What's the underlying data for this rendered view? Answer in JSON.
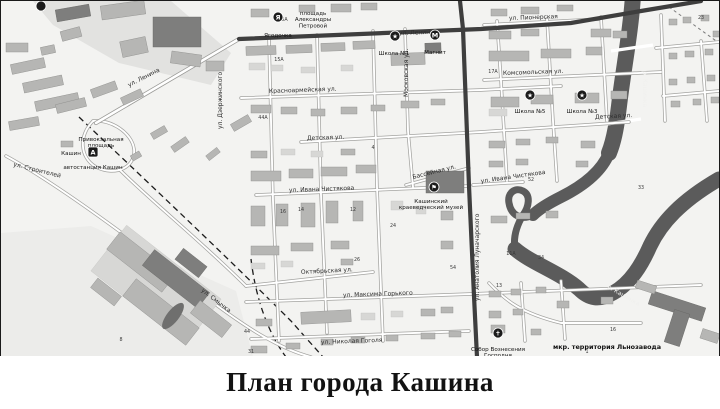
{
  "title": "План города Кашина",
  "map": {
    "colors": {
      "background": "#f3f3f1",
      "river": "#5b5b5b",
      "major_road": "#3e3e3e",
      "building": "#b6b6b4",
      "building_dark": "#7e7e7d",
      "industrial_zone": "#e2e2e0"
    },
    "river_name": "р. Кашинка",
    "street_labels": [
      {
        "t": "ул. Ленина",
        "x": 128,
        "y": 86,
        "r": -27
      },
      {
        "t": "ул. Ленина",
        "x": 398,
        "y": 34,
        "r": -2
      },
      {
        "t": "ул. Пионерская",
        "x": 508,
        "y": 19,
        "r": -2
      },
      {
        "t": "Красноармейская ул.",
        "x": 268,
        "y": 92,
        "r": -2
      },
      {
        "t": "Комсомольская ул.",
        "x": 502,
        "y": 74,
        "r": -2
      },
      {
        "t": "Детская ул.",
        "x": 594,
        "y": 118,
        "r": -3
      },
      {
        "t": "Детская ул.",
        "x": 306,
        "y": 139,
        "r": -2
      },
      {
        "t": "ул. Ивана Чистякова",
        "x": 288,
        "y": 191,
        "r": -2
      },
      {
        "t": "ул. Ивана Чистякова",
        "x": 480,
        "y": 182,
        "r": -8
      },
      {
        "t": "Бассейная ул.",
        "x": 412,
        "y": 178,
        "r": -14
      },
      {
        "t": "Московская ул.",
        "x": 407,
        "y": 96,
        "r": -90
      },
      {
        "t": "ул. Дзержинского",
        "x": 221,
        "y": 128,
        "r": -90
      },
      {
        "t": "ул. Анатолия Луначарского",
        "x": 478,
        "y": 300,
        "r": -90
      },
      {
        "t": "Октябрьская ул.",
        "x": 300,
        "y": 273,
        "r": -3
      },
      {
        "t": "ул. Максима Горького",
        "x": 342,
        "y": 296,
        "r": -2
      },
      {
        "t": "ул. Смычка",
        "x": 200,
        "y": 290,
        "r": 38
      },
      {
        "t": "ул. Строителей",
        "x": 12,
        "y": 165,
        "r": 14
      },
      {
        "t": "ул. Николая Гоголя",
        "x": 320,
        "y": 343,
        "r": -2
      }
    ],
    "river_labels": [
      {
        "t": "р. Кашинка",
        "x": 642,
        "y": 70,
        "r": 90
      },
      {
        "t": "р. Кашинка",
        "x": 606,
        "y": 287,
        "r": 30
      }
    ],
    "place_labels": [
      {
        "lines": [
          "площадь",
          "Александры",
          "Петровой"
        ],
        "x": 312,
        "y": 8,
        "b": 0
      },
      {
        "lines": [
          "Привокзальная",
          "площадь"
        ],
        "x": 100,
        "y": 134,
        "b": 0
      },
      {
        "lines": [
          "Кашин"
        ],
        "x": 70,
        "y": 148,
        "b": 1
      },
      {
        "lines": [
          "автостанция Кашин"
        ],
        "x": 92,
        "y": 162,
        "b": 1
      },
      {
        "lines": [
          "Ягодочка"
        ],
        "x": 277,
        "y": 30,
        "b": 1
      },
      {
        "lines": [
          "Школа №1"
        ],
        "x": 393,
        "y": 48,
        "b": 1
      },
      {
        "lines": [
          "Магнит"
        ],
        "x": 434,
        "y": 47,
        "b": 1
      },
      {
        "lines": [
          "Школа №5"
        ],
        "x": 529,
        "y": 106,
        "b": 1
      },
      {
        "lines": [
          "Школа №3"
        ],
        "x": 581,
        "y": 106,
        "b": 1
      },
      {
        "lines": [
          "Кашинский",
          "краеведческий музей"
        ],
        "x": 430,
        "y": 196,
        "b": 1
      },
      {
        "lines": [
          "Собор Вознесения",
          "Господня"
        ],
        "x": 497,
        "y": 344,
        "b": 1
      },
      {
        "lines": [
          "мкр. территория Льнозавода"
        ],
        "x": 606,
        "y": 342,
        "b": 2
      }
    ],
    "house_numbers": [
      {
        "t": "15А",
        "x": 278,
        "y": 60
      },
      {
        "t": "44А",
        "x": 262,
        "y": 118
      },
      {
        "t": "4",
        "x": 372,
        "y": 148
      },
      {
        "t": "12",
        "x": 352,
        "y": 210
      },
      {
        "t": "14",
        "x": 300,
        "y": 210
      },
      {
        "t": "16",
        "x": 282,
        "y": 212
      },
      {
        "t": "26",
        "x": 356,
        "y": 260
      },
      {
        "t": "24",
        "x": 392,
        "y": 226
      },
      {
        "t": "11А",
        "x": 510,
        "y": 254
      },
      {
        "t": "13",
        "x": 498,
        "y": 286
      },
      {
        "t": "34",
        "x": 540,
        "y": 258
      },
      {
        "t": "54",
        "x": 452,
        "y": 268
      },
      {
        "t": "16",
        "x": 612,
        "y": 330
      },
      {
        "t": "23",
        "x": 700,
        "y": 18
      },
      {
        "t": "33",
        "x": 640,
        "y": 188
      },
      {
        "t": "31",
        "x": 250,
        "y": 352
      },
      {
        "t": "44",
        "x": 246,
        "y": 332
      },
      {
        "t": "52",
        "x": 530,
        "y": 180
      },
      {
        "t": "25А",
        "x": 282,
        "y": 20
      },
      {
        "t": "17А",
        "x": 492,
        "y": 72
      },
      {
        "t": "8",
        "x": 120,
        "y": 340
      },
      {
        "t": "1",
        "x": 586,
        "y": 352
      }
    ],
    "pois": [
      {
        "id": "bus-station",
        "glyph": "А",
        "shape": "square",
        "x": 92,
        "y": 151
      },
      {
        "id": "shop-yagodochka",
        "glyph": "Я",
        "shape": "circle",
        "x": 277,
        "y": 16
      },
      {
        "id": "school-1",
        "glyph": "★",
        "shape": "circle",
        "x": 394,
        "y": 35
      },
      {
        "id": "shop-magnit",
        "glyph": "М",
        "shape": "circle",
        "x": 434,
        "y": 34
      },
      {
        "id": "school-5",
        "glyph": "★",
        "shape": "circle",
        "x": 529,
        "y": 94
      },
      {
        "id": "school-3",
        "glyph": "★",
        "shape": "circle",
        "x": 581,
        "y": 94
      },
      {
        "id": "museum",
        "glyph": "⚑",
        "shape": "circle",
        "x": 433,
        "y": 186
      },
      {
        "id": "church",
        "glyph": "✝",
        "shape": "circle",
        "x": 497,
        "y": 332
      },
      {
        "id": "transit-stop",
        "glyph": "",
        "shape": "circle",
        "x": 40,
        "y": 5
      }
    ],
    "buildings": [
      [
        55,
        6,
        34,
        12,
        -10,
        2
      ],
      [
        100,
        2,
        44,
        14,
        -8,
        1
      ],
      [
        152,
        16,
        48,
        30,
        0,
        2
      ],
      [
        120,
        38,
        26,
        16,
        -12,
        1
      ],
      [
        60,
        28,
        20,
        10,
        -15,
        1
      ],
      [
        170,
        52,
        30,
        12,
        8,
        1
      ],
      [
        205,
        60,
        18,
        10,
        0,
        1
      ],
      [
        10,
        60,
        34,
        10,
        -12,
        1
      ],
      [
        22,
        78,
        40,
        10,
        -12,
        1
      ],
      [
        34,
        96,
        44,
        10,
        -12,
        1
      ],
      [
        8,
        118,
        30,
        9,
        -10,
        1
      ],
      [
        55,
        100,
        30,
        9,
        -14,
        1
      ],
      [
        90,
        84,
        26,
        9,
        -20,
        1
      ],
      [
        120,
        92,
        22,
        8,
        -25,
        1
      ],
      [
        5,
        42,
        22,
        9,
        0,
        1
      ],
      [
        40,
        45,
        14,
        8,
        -12,
        1
      ],
      [
        150,
        128,
        16,
        7,
        -30,
        1
      ],
      [
        170,
        140,
        18,
        7,
        -35,
        1
      ],
      [
        205,
        150,
        14,
        6,
        -38,
        1
      ],
      [
        230,
        118,
        20,
        8,
        -30,
        1
      ],
      [
        60,
        140,
        12,
        6,
        0,
        1
      ],
      [
        130,
        152,
        10,
        6,
        -30,
        1
      ],
      [
        250,
        8,
        18,
        8,
        0,
        1
      ],
      [
        298,
        4,
        16,
        7,
        0,
        1
      ],
      [
        330,
        3,
        20,
        8,
        0,
        1
      ],
      [
        360,
        2,
        16,
        7,
        0,
        1
      ],
      [
        245,
        45,
        30,
        9,
        -2,
        1
      ],
      [
        285,
        44,
        26,
        8,
        -2,
        1
      ],
      [
        320,
        42,
        24,
        8,
        -2,
        1
      ],
      [
        352,
        40,
        22,
        8,
        -2,
        1
      ],
      [
        390,
        52,
        34,
        12,
        -2,
        1
      ],
      [
        424,
        42,
        16,
        10,
        -2,
        2
      ],
      [
        248,
        62,
        16,
        7,
        0,
        0
      ],
      [
        270,
        64,
        12,
        6,
        0,
        0
      ],
      [
        300,
        66,
        14,
        6,
        0,
        0
      ],
      [
        340,
        64,
        12,
        6,
        0,
        0
      ],
      [
        250,
        104,
        20,
        8,
        0,
        1
      ],
      [
        280,
        106,
        16,
        7,
        0,
        1
      ],
      [
        310,
        108,
        14,
        7,
        0,
        1
      ],
      [
        340,
        106,
        16,
        7,
        0,
        1
      ],
      [
        370,
        104,
        14,
        6,
        0,
        1
      ],
      [
        400,
        100,
        18,
        7,
        0,
        1
      ],
      [
        430,
        98,
        14,
        6,
        0,
        1
      ],
      [
        490,
        8,
        16,
        7,
        0,
        1
      ],
      [
        520,
        6,
        18,
        7,
        0,
        1
      ],
      [
        556,
        4,
        16,
        6,
        0,
        1
      ],
      [
        590,
        28,
        20,
        8,
        0,
        1
      ],
      [
        488,
        30,
        22,
        8,
        0,
        1
      ],
      [
        520,
        28,
        18,
        7,
        0,
        1
      ],
      [
        488,
        50,
        40,
        10,
        0,
        1
      ],
      [
        540,
        48,
        30,
        9,
        0,
        1
      ],
      [
        585,
        46,
        16,
        8,
        0,
        1
      ],
      [
        612,
        30,
        14,
        7,
        0,
        1
      ],
      [
        490,
        96,
        28,
        10,
        0,
        1
      ],
      [
        530,
        94,
        22,
        9,
        0,
        1
      ],
      [
        574,
        92,
        24,
        10,
        0,
        1
      ],
      [
        610,
        90,
        16,
        8,
        0,
        1
      ],
      [
        488,
        108,
        18,
        7,
        0,
        0
      ],
      [
        668,
        18,
        8,
        6,
        0,
        1
      ],
      [
        682,
        16,
        8,
        6,
        0,
        1
      ],
      [
        700,
        14,
        8,
        6,
        0,
        1
      ],
      [
        712,
        30,
        7,
        6,
        0,
        1
      ],
      [
        668,
        52,
        8,
        6,
        0,
        1
      ],
      [
        684,
        50,
        9,
        6,
        0,
        1
      ],
      [
        704,
        48,
        8,
        6,
        0,
        1
      ],
      [
        668,
        78,
        8,
        6,
        0,
        1
      ],
      [
        686,
        76,
        8,
        6,
        0,
        1
      ],
      [
        706,
        74,
        8,
        6,
        0,
        1
      ],
      [
        670,
        100,
        9,
        6,
        0,
        1
      ],
      [
        692,
        98,
        8,
        6,
        0,
        1
      ],
      [
        710,
        96,
        8,
        6,
        0,
        1
      ],
      [
        250,
        150,
        16,
        7,
        0,
        1
      ],
      [
        280,
        148,
        14,
        6,
        0,
        0
      ],
      [
        310,
        150,
        12,
        6,
        0,
        0
      ],
      [
        340,
        148,
        14,
        6,
        0,
        1
      ],
      [
        250,
        170,
        30,
        10,
        0,
        1
      ],
      [
        288,
        168,
        24,
        9,
        0,
        1
      ],
      [
        320,
        166,
        26,
        9,
        0,
        1
      ],
      [
        355,
        164,
        20,
        8,
        0,
        1
      ],
      [
        250,
        205,
        14,
        20,
        0,
        1
      ],
      [
        275,
        203,
        12,
        22,
        0,
        1
      ],
      [
        300,
        202,
        14,
        24,
        0,
        1
      ],
      [
        325,
        200,
        12,
        22,
        0,
        1
      ],
      [
        352,
        200,
        10,
        20,
        0,
        1
      ],
      [
        390,
        200,
        12,
        9,
        0,
        0
      ],
      [
        415,
        205,
        10,
        8,
        0,
        0
      ],
      [
        440,
        210,
        12,
        9,
        0,
        1
      ],
      [
        250,
        245,
        28,
        9,
        0,
        1
      ],
      [
        290,
        242,
        22,
        8,
        0,
        1
      ],
      [
        330,
        240,
        18,
        8,
        0,
        1
      ],
      [
        440,
        240,
        12,
        8,
        0,
        1
      ],
      [
        425,
        170,
        38,
        22,
        0,
        2
      ],
      [
        488,
        140,
        16,
        7,
        0,
        1
      ],
      [
        515,
        138,
        14,
        6,
        0,
        1
      ],
      [
        545,
        136,
        12,
        6,
        0,
        1
      ],
      [
        488,
        160,
        14,
        6,
        0,
        1
      ],
      [
        515,
        158,
        12,
        6,
        0,
        1
      ],
      [
        490,
        215,
        16,
        7,
        0,
        1
      ],
      [
        515,
        212,
        14,
        6,
        0,
        1
      ],
      [
        545,
        210,
        12,
        7,
        0,
        1
      ],
      [
        575,
        160,
        12,
        6,
        0,
        1
      ],
      [
        580,
        140,
        14,
        7,
        0,
        1
      ],
      [
        250,
        262,
        14,
        6,
        0,
        0
      ],
      [
        280,
        260,
        12,
        6,
        0,
        0
      ],
      [
        340,
        258,
        12,
        6,
        0,
        1
      ],
      [
        300,
        310,
        50,
        12,
        -3,
        1
      ],
      [
        255,
        318,
        16,
        7,
        0,
        1
      ],
      [
        360,
        312,
        14,
        7,
        0,
        0
      ],
      [
        390,
        310,
        12,
        6,
        0,
        0
      ],
      [
        420,
        308,
        14,
        7,
        0,
        1
      ],
      [
        440,
        306,
        12,
        6,
        0,
        1
      ],
      [
        250,
        345,
        16,
        7,
        0,
        1
      ],
      [
        285,
        342,
        14,
        6,
        0,
        1
      ],
      [
        320,
        338,
        12,
        6,
        0,
        1
      ],
      [
        350,
        336,
        14,
        6,
        0,
        1
      ],
      [
        385,
        334,
        12,
        6,
        0,
        1
      ],
      [
        420,
        332,
        14,
        6,
        0,
        1
      ],
      [
        448,
        330,
        12,
        6,
        0,
        1
      ],
      [
        488,
        290,
        12,
        6,
        0,
        1
      ],
      [
        510,
        288,
        10,
        6,
        0,
        1
      ],
      [
        535,
        286,
        10,
        6,
        0,
        1
      ],
      [
        488,
        310,
        12,
        7,
        0,
        1
      ],
      [
        512,
        308,
        10,
        6,
        0,
        1
      ],
      [
        490,
        324,
        14,
        8,
        0,
        1
      ],
      [
        530,
        328,
        10,
        6,
        0,
        1
      ],
      [
        556,
        300,
        12,
        7,
        0,
        1
      ],
      [
        600,
        296,
        12,
        7,
        0,
        1
      ],
      [
        95,
        255,
        120,
        58,
        38,
        0
      ],
      [
        105,
        250,
        70,
        22,
        38,
        1
      ],
      [
        140,
        268,
        70,
        20,
        38,
        2
      ],
      [
        120,
        300,
        80,
        22,
        38,
        1
      ],
      [
        175,
        255,
        30,
        14,
        38,
        2
      ],
      [
        90,
        285,
        30,
        12,
        38,
        1
      ],
      [
        190,
        310,
        40,
        16,
        38,
        1
      ],
      [
        648,
        298,
        56,
        14,
        18,
        2
      ],
      [
        668,
        310,
        16,
        34,
        18,
        2
      ],
      [
        700,
        330,
        18,
        10,
        18,
        1
      ],
      [
        635,
        282,
        20,
        8,
        18,
        1
      ]
    ]
  }
}
